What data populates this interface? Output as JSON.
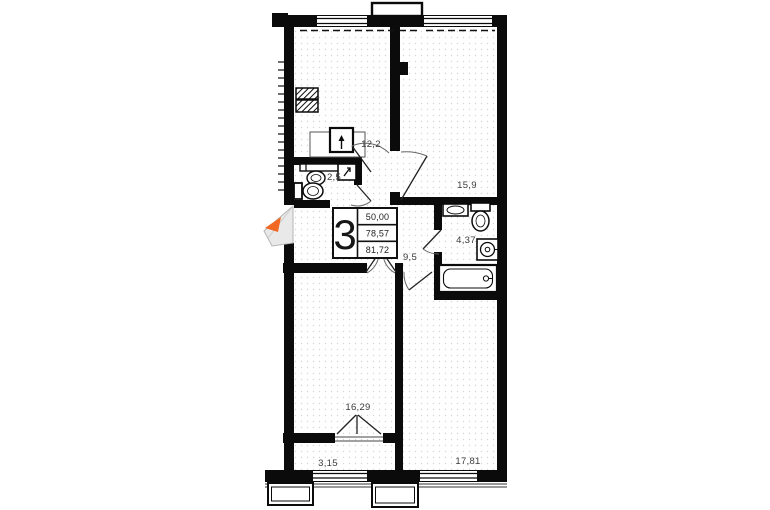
{
  "plan": {
    "type": "apartment floor plan",
    "badge": {
      "room_count": "3",
      "living_area": "50,00",
      "area_without_balcony": "78,57",
      "total_area": "81,72"
    },
    "rooms": {
      "kitchen": "12,2",
      "bedroom_top_right": "15,9",
      "wc": "2,5",
      "bathroom": "4,37",
      "hallway": "9,5",
      "living_room": "16,29",
      "balcony": "3,15",
      "bedroom_bottom_right": "17,81"
    },
    "colors": {
      "wall": "#0b0b0b",
      "entrance_arrow": "#f26822",
      "floor_dot": "#cfcfcf",
      "door_leaf_fill": "#e9e9e9"
    }
  }
}
